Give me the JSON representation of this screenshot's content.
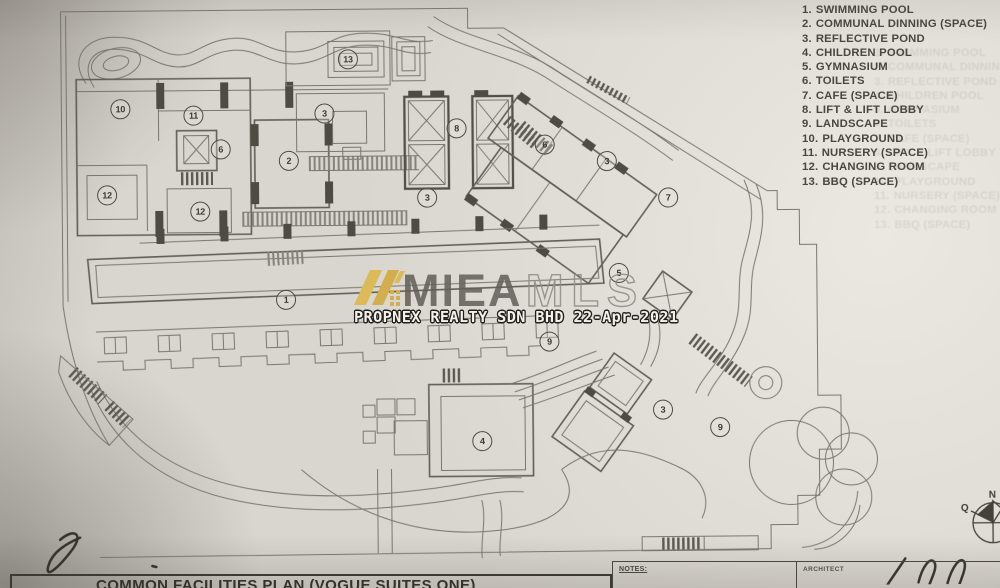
{
  "legend": {
    "items": [
      {
        "num": "1.",
        "label": "SWIMMING POOL"
      },
      {
        "num": "2.",
        "label": "COMMUNAL DINNING (SPACE)"
      },
      {
        "num": "3.",
        "label": "REFLECTIVE POND"
      },
      {
        "num": "4.",
        "label": "CHILDREN POOL"
      },
      {
        "num": "5.",
        "label": "GYMNASIUM"
      },
      {
        "num": "6.",
        "label": "TOILETS"
      },
      {
        "num": "7.",
        "label": "CAFE (SPACE)"
      },
      {
        "num": "8.",
        "label": "LIFT & LIFT LOBBY"
      },
      {
        "num": "9.",
        "label": "LANDSCAPE"
      },
      {
        "num": "10.",
        "label": "PLAYGROUND"
      },
      {
        "num": "11.",
        "label": "NURSERY (SPACE)"
      },
      {
        "num": "12.",
        "label": "CHANGING ROOM"
      },
      {
        "num": "13.",
        "label": "BBQ (SPACE)"
      }
    ]
  },
  "watermark": {
    "brand_bold": "MIEA",
    "brand_outline": "MLS",
    "stamp": "PROPNEX REALTY SDN BHD 22-Apr-2021",
    "logo_color": "#dcba58"
  },
  "title_block": {
    "title": "COMMON FACILITIES PLAN (VOGUE SUITES ONE)",
    "notes_label": "NOTES:",
    "architect_label": "ARCHITECT"
  },
  "compass": {
    "north": "N",
    "west": "Q"
  },
  "plan": {
    "markers": [
      {
        "n": "10",
        "x": 121,
        "y": 105
      },
      {
        "n": "11",
        "x": 194,
        "y": 112
      },
      {
        "n": "6",
        "x": 221,
        "y": 146
      },
      {
        "n": "12",
        "x": 107,
        "y": 191
      },
      {
        "n": "12",
        "x": 200,
        "y": 208
      },
      {
        "n": "2",
        "x": 289,
        "y": 158
      },
      {
        "n": "3",
        "x": 325,
        "y": 111
      },
      {
        "n": "13",
        "x": 349,
        "y": 57
      },
      {
        "n": "8",
        "x": 457,
        "y": 127
      },
      {
        "n": "3",
        "x": 427,
        "y": 196
      },
      {
        "n": "6",
        "x": 545,
        "y": 144
      },
      {
        "n": "3",
        "x": 607,
        "y": 161
      },
      {
        "n": "7",
        "x": 668,
        "y": 198
      },
      {
        "n": "5",
        "x": 618,
        "y": 273
      },
      {
        "n": "1",
        "x": 285,
        "y": 297
      },
      {
        "n": "9",
        "x": 548,
        "y": 341
      },
      {
        "n": "3",
        "x": 661,
        "y": 410
      },
      {
        "n": "9",
        "x": 718,
        "y": 428
      },
      {
        "n": "4",
        "x": 480,
        "y": 440
      }
    ]
  }
}
